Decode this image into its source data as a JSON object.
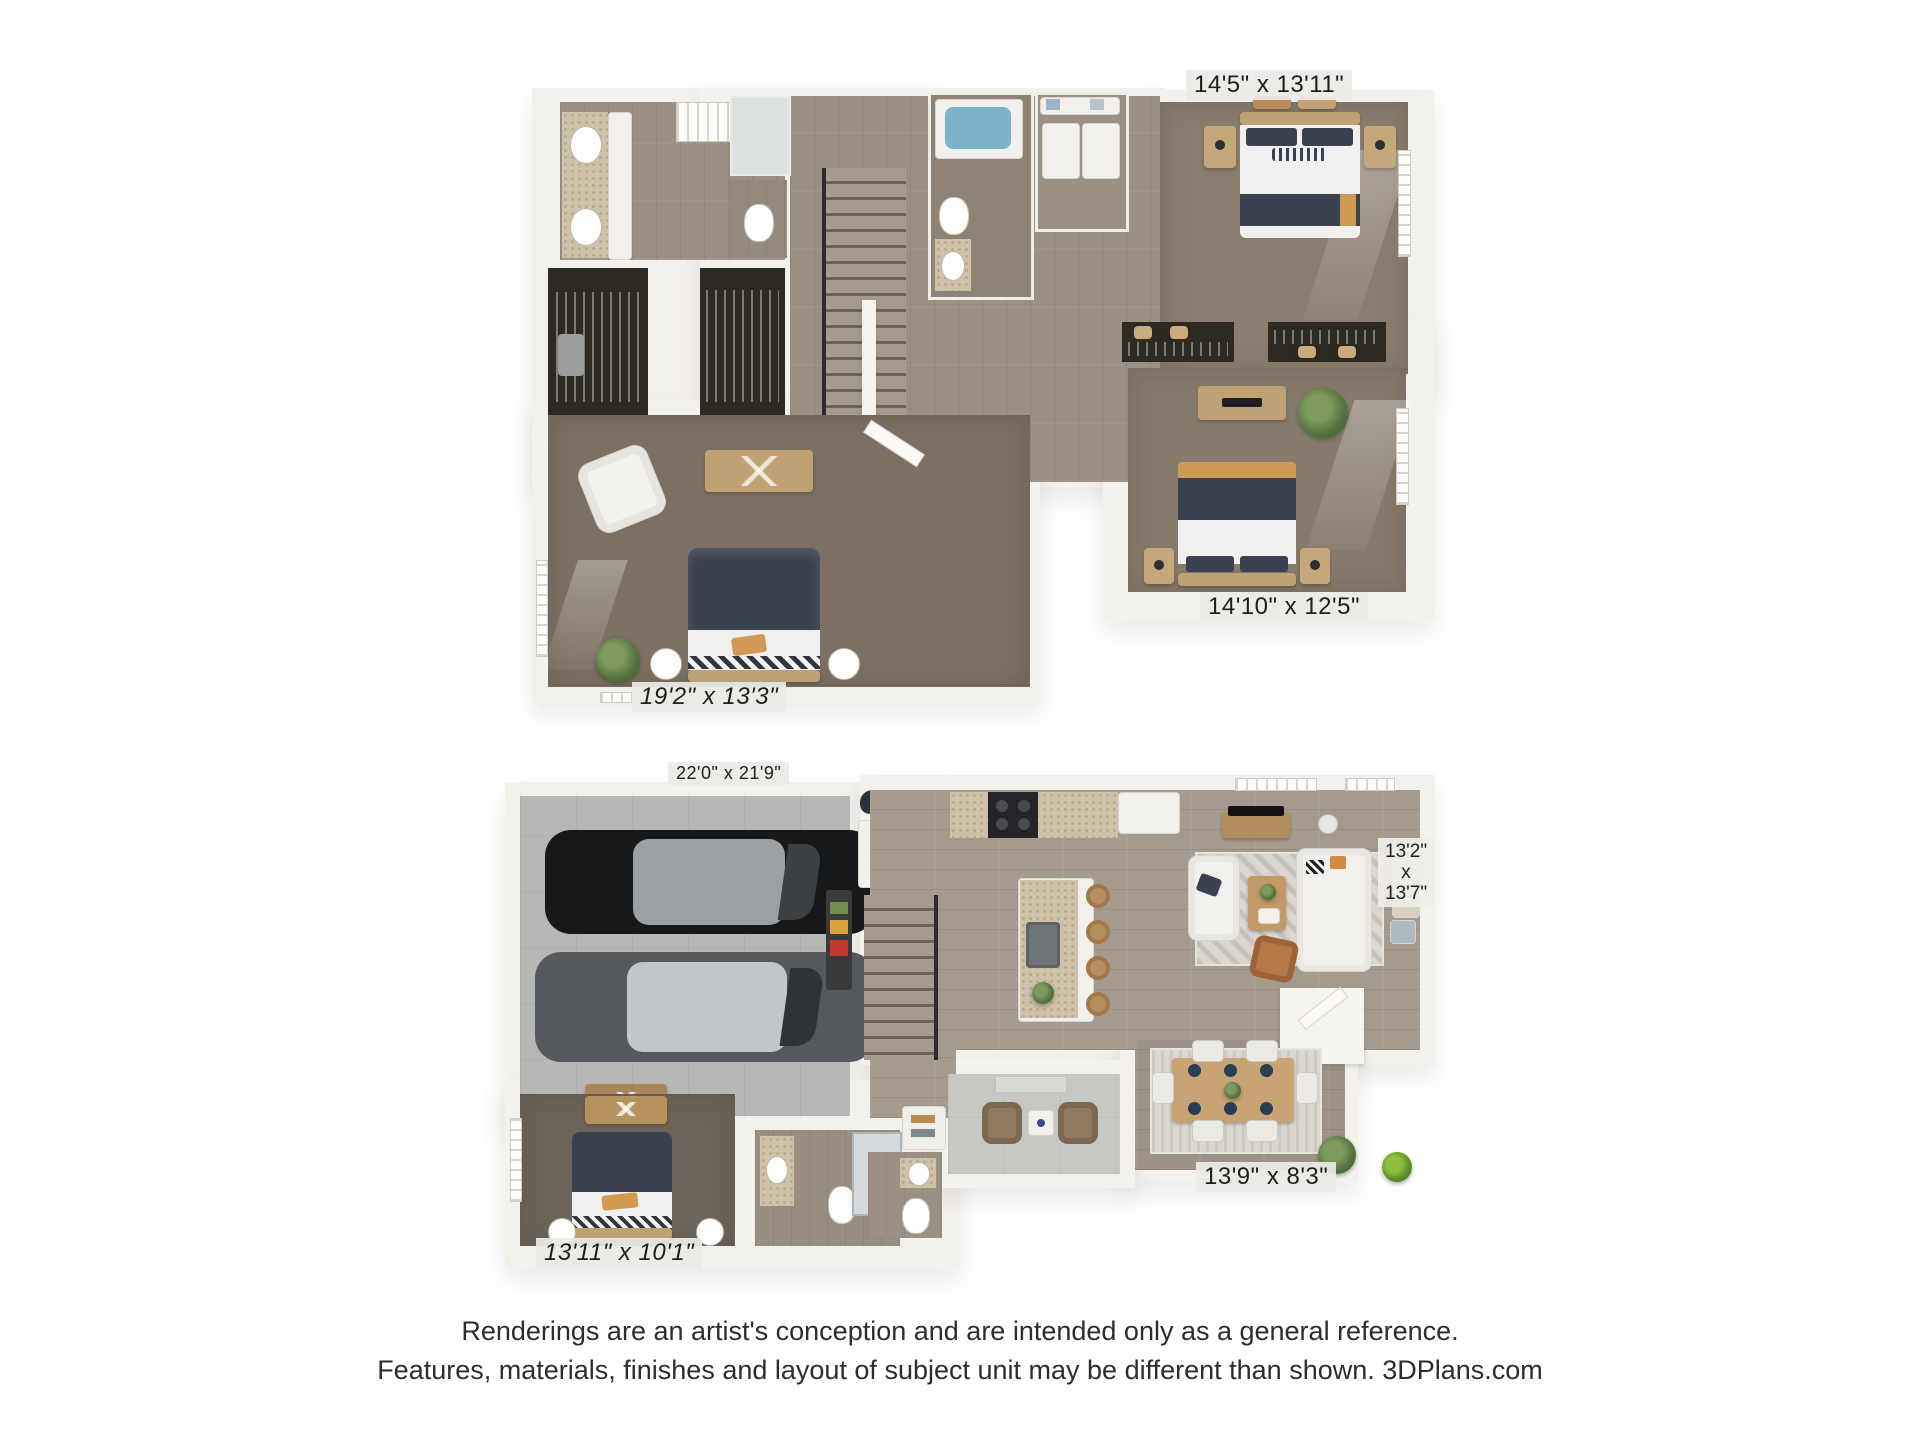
{
  "plans": {
    "upper": {
      "labels": {
        "bedroom1": "14'5\" x 13'11\"",
        "bedroom2": "14'10\" x 12'5\"",
        "master": "19'2\" x 13'3\""
      }
    },
    "lower": {
      "labels": {
        "garage": "22'0\" x 21'9\"",
        "living": [
          "13'2\"",
          "x",
          "13'7\""
        ],
        "dining": "13'9\" x 8'3\"",
        "bedroom": "13'11\" x 10'1\""
      }
    }
  },
  "disclaimer": {
    "line1": "Renderings are an artist's conception and are intended only as a general reference.",
    "line2": "Features, materials, finishes and layout of subject unit may be different than shown. 3DPlans.com"
  },
  "colors": {
    "background": "#ffffff",
    "wall": "#f3f1ec",
    "wood_floor": "#a49a8e",
    "carpet": "#7d7164",
    "garage_concrete": "#b7b8b5",
    "granite": "#cdc1a8",
    "bedding_navy": "#3a4150",
    "accent_orange": "#d09a55",
    "label_background": "#eceae6",
    "text": "#1e1e1e"
  }
}
